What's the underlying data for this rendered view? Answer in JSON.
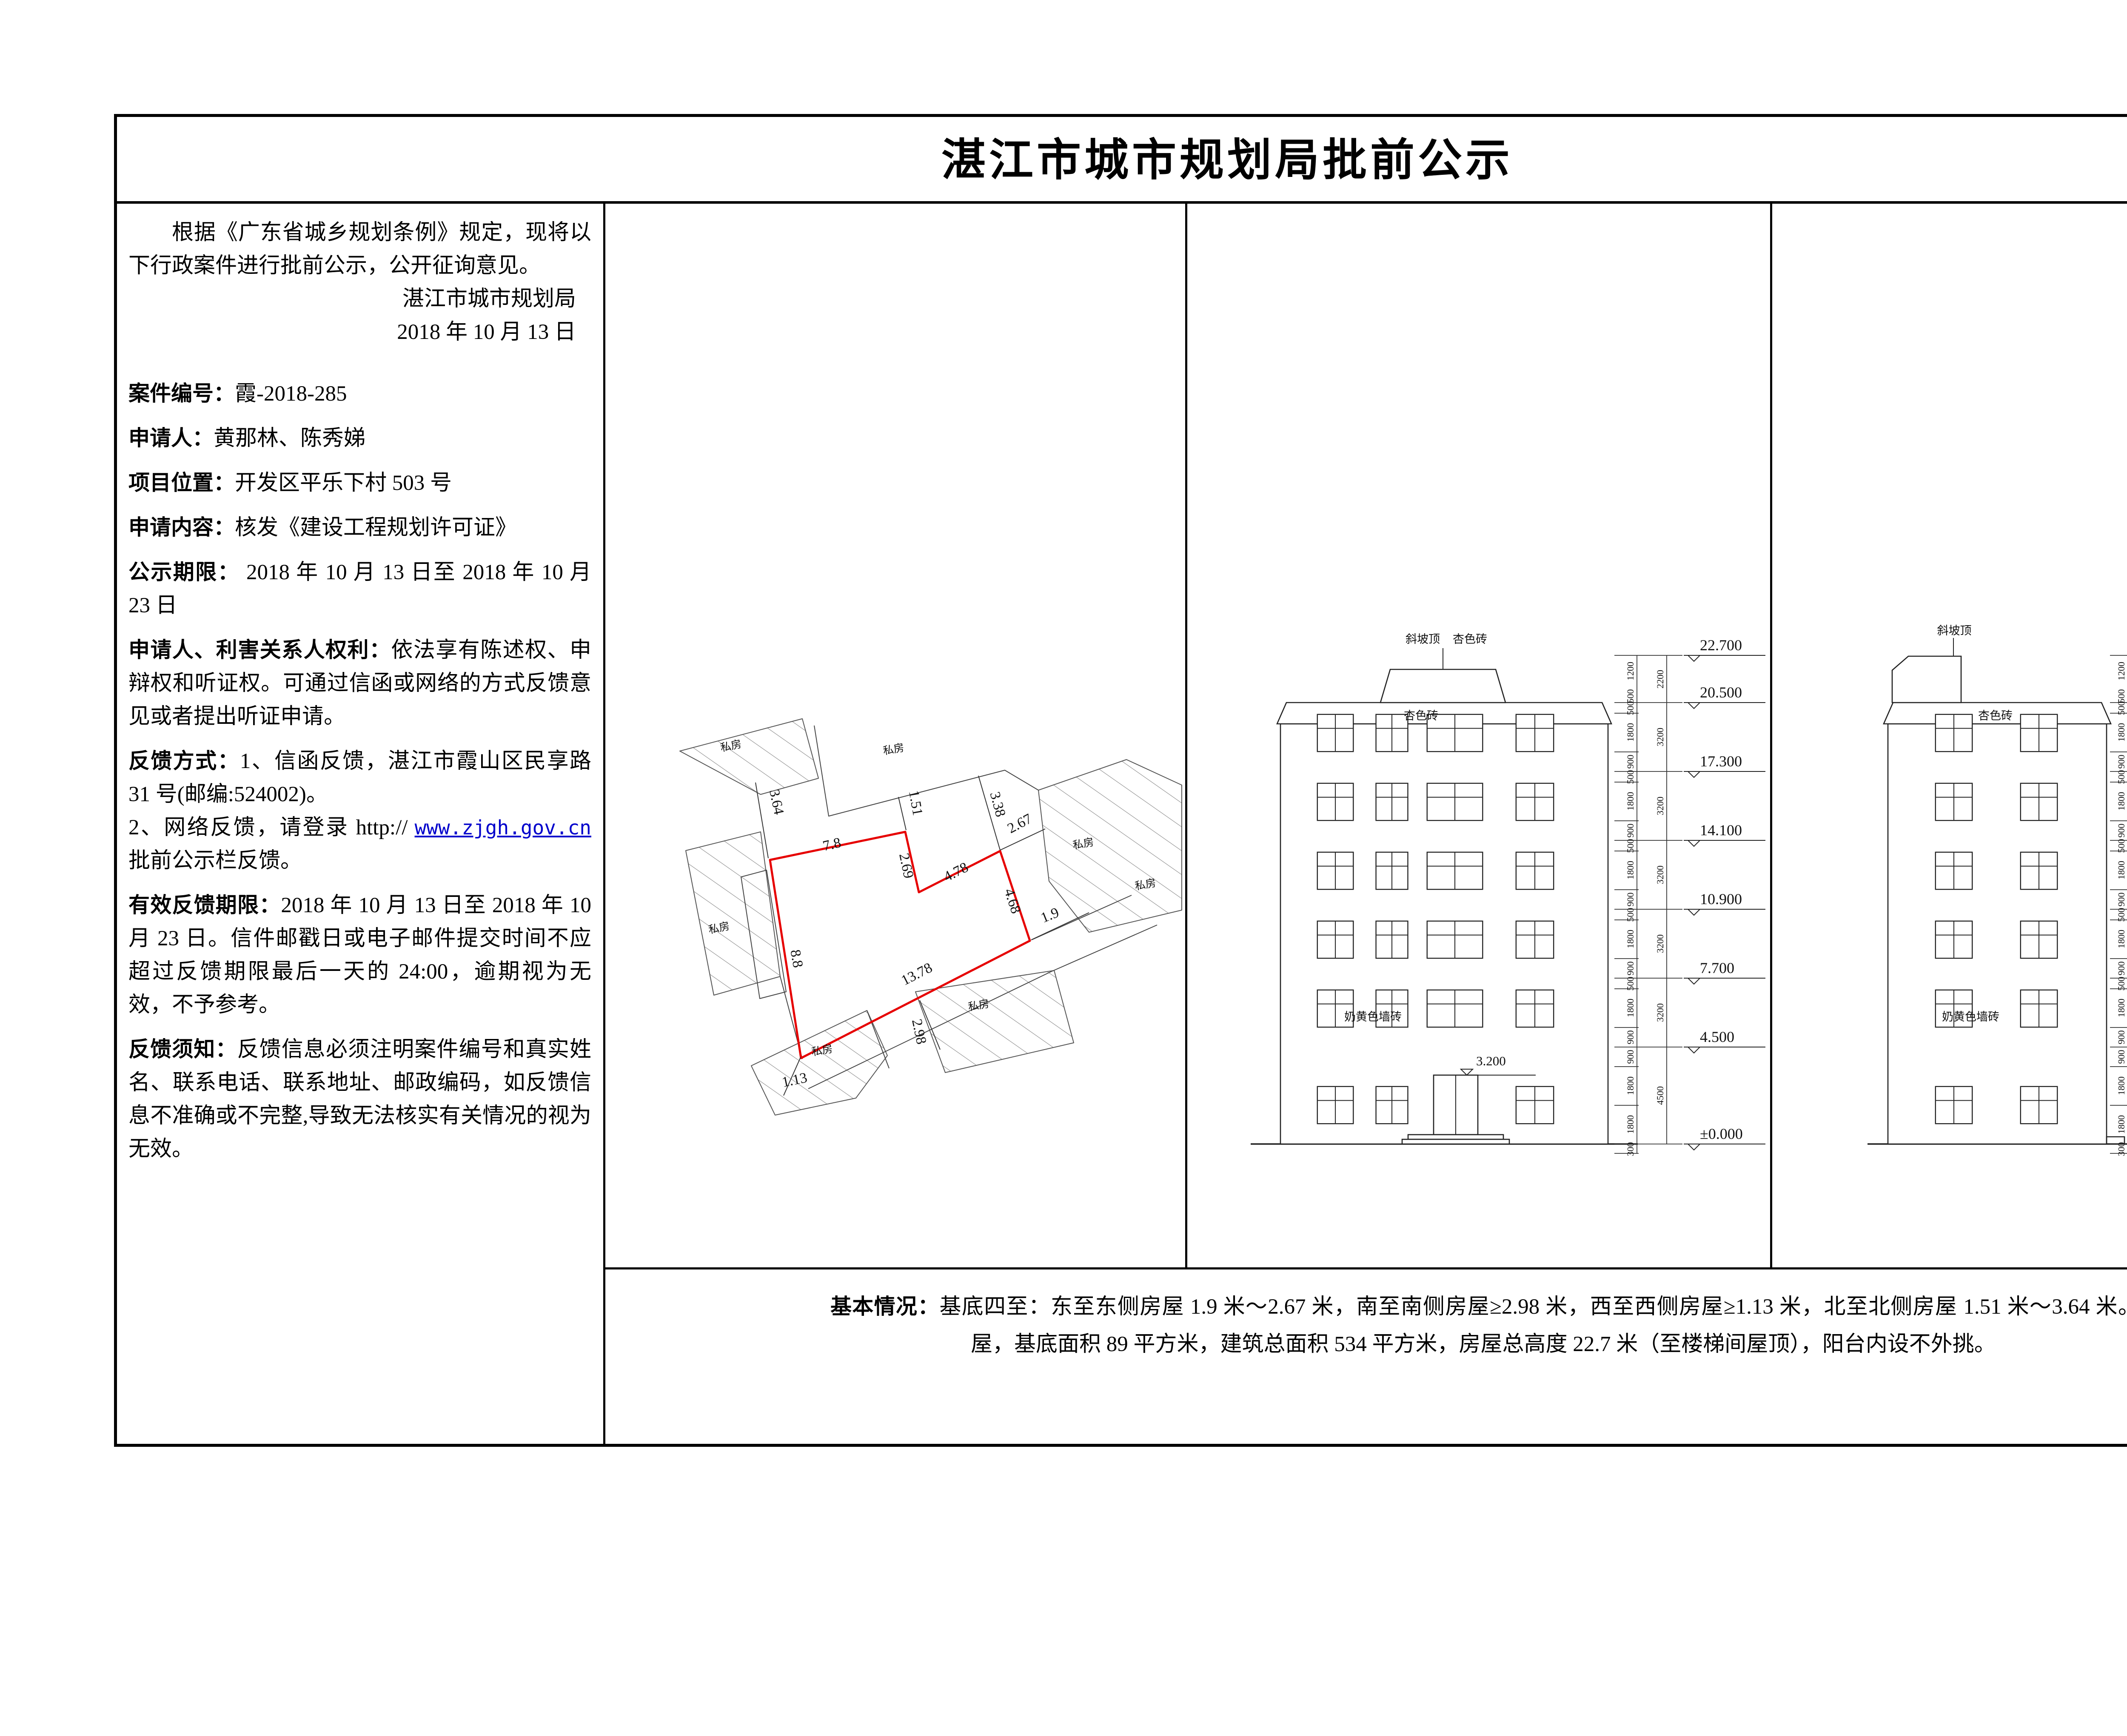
{
  "title": "湛江市城市规划局批前公示",
  "left": {
    "intro": "根据《广东省城乡规划条例》规定，现将以下行政案件进行批前公示，公开征询意见。",
    "agency": "湛江市城市规划局",
    "date": "2018 年 10 月 13 日",
    "fields": [
      {
        "label": "案件编号：",
        "value": "霞-2018-285"
      },
      {
        "label": "申请人：",
        "value": "黄那林、陈秀娣"
      },
      {
        "label": "项目位置：",
        "value": "开发区平乐下村 503 号"
      },
      {
        "label": "申请内容：",
        "value": "核发《建设工程规划许可证》"
      },
      {
        "label": "公示期限：",
        "value": " 2018 年 10 月 13 日至 2018 年 10 月 23 日"
      },
      {
        "label": "申请人、利害关系人权利：",
        "value": "依法享有陈述权、申辩权和听证权。可通过信函或网络的方式反馈意见或者提出听证申请。"
      },
      {
        "label": "反馈方式：",
        "value": "1、信函反馈，湛江市霞山区民享路 31 号(邮编:524002)。"
      }
    ],
    "web_feedback": {
      "prefix": "2、网络反馈，请登录 http:// ",
      "link": "www.zjgh.gov.cn",
      "suffix": " 批前公示栏反馈。"
    },
    "fields2": [
      {
        "label": "有效反馈期限：",
        "value": "2018 年 10 月 13 日至 2018 年 10 月 23 日。信件邮戳日或电子邮件提交时间不应超过反馈期限最后一天的 24:00，逾期视为无效，不予参考。"
      },
      {
        "label": "反馈须知：",
        "value": "反馈信息必须注明案件编号和真实姓名、联系电话、联系地址、邮政编码，如反馈信息不准确或不完整,导致无法核实有关情况的视为无效。"
      }
    ]
  },
  "site_plan": {
    "neighbor_label": "私房",
    "dims": {
      "top": "7.8",
      "notch": "2.69",
      "upper_right": "4.78",
      "right": "4.68",
      "bottom": "13.78",
      "left": "8.8",
      "gap_top_left": "3.64",
      "gap_top": "1.51",
      "gap_top_right": "3.38",
      "gap_right_upper": "2.67",
      "gap_right": "1.9",
      "gap_bottom": "2.98",
      "gap_bottom_left": "1.13"
    }
  },
  "elevations": {
    "levels": [
      "22.700",
      "20.500",
      "17.300",
      "14.100",
      "10.900",
      "7.700",
      "4.500",
      "±0.000"
    ],
    "door_level": "3.200",
    "dims_inner": [
      "1200",
      "500",
      "500",
      "1800",
      "900",
      "500",
      "1800",
      "900",
      "500",
      "1800",
      "900",
      "500",
      "1800",
      "900",
      "500",
      "1800",
      "900",
      "900",
      "1800",
      "1800",
      "300"
    ],
    "dims_outer": [
      "2200",
      "3200",
      "3200",
      "3200",
      "3200",
      "3200",
      "4500"
    ],
    "labels": {
      "roof": "斜坡顶",
      "brick": "杏色砖",
      "wall_brick": "奶黄色墙砖"
    }
  },
  "bottom": {
    "label": "基本情况：",
    "text": "基底四至：东至东侧房屋 1.9 米～2.67 米，南至南侧房屋≥2.98 米，西至西侧房屋≥1.13 米，北至北侧房屋 1.51 米～3.64 米。房屋规模：一幢框架结构六层房屋，基底面积 89 平方米，建筑总面积 534 平方米，房屋总高度 22.7 米（至楼梯间屋顶），阳台内设不外挑。"
  },
  "colors": {
    "plot_outline": "#e60000",
    "link": "#0000cc"
  }
}
